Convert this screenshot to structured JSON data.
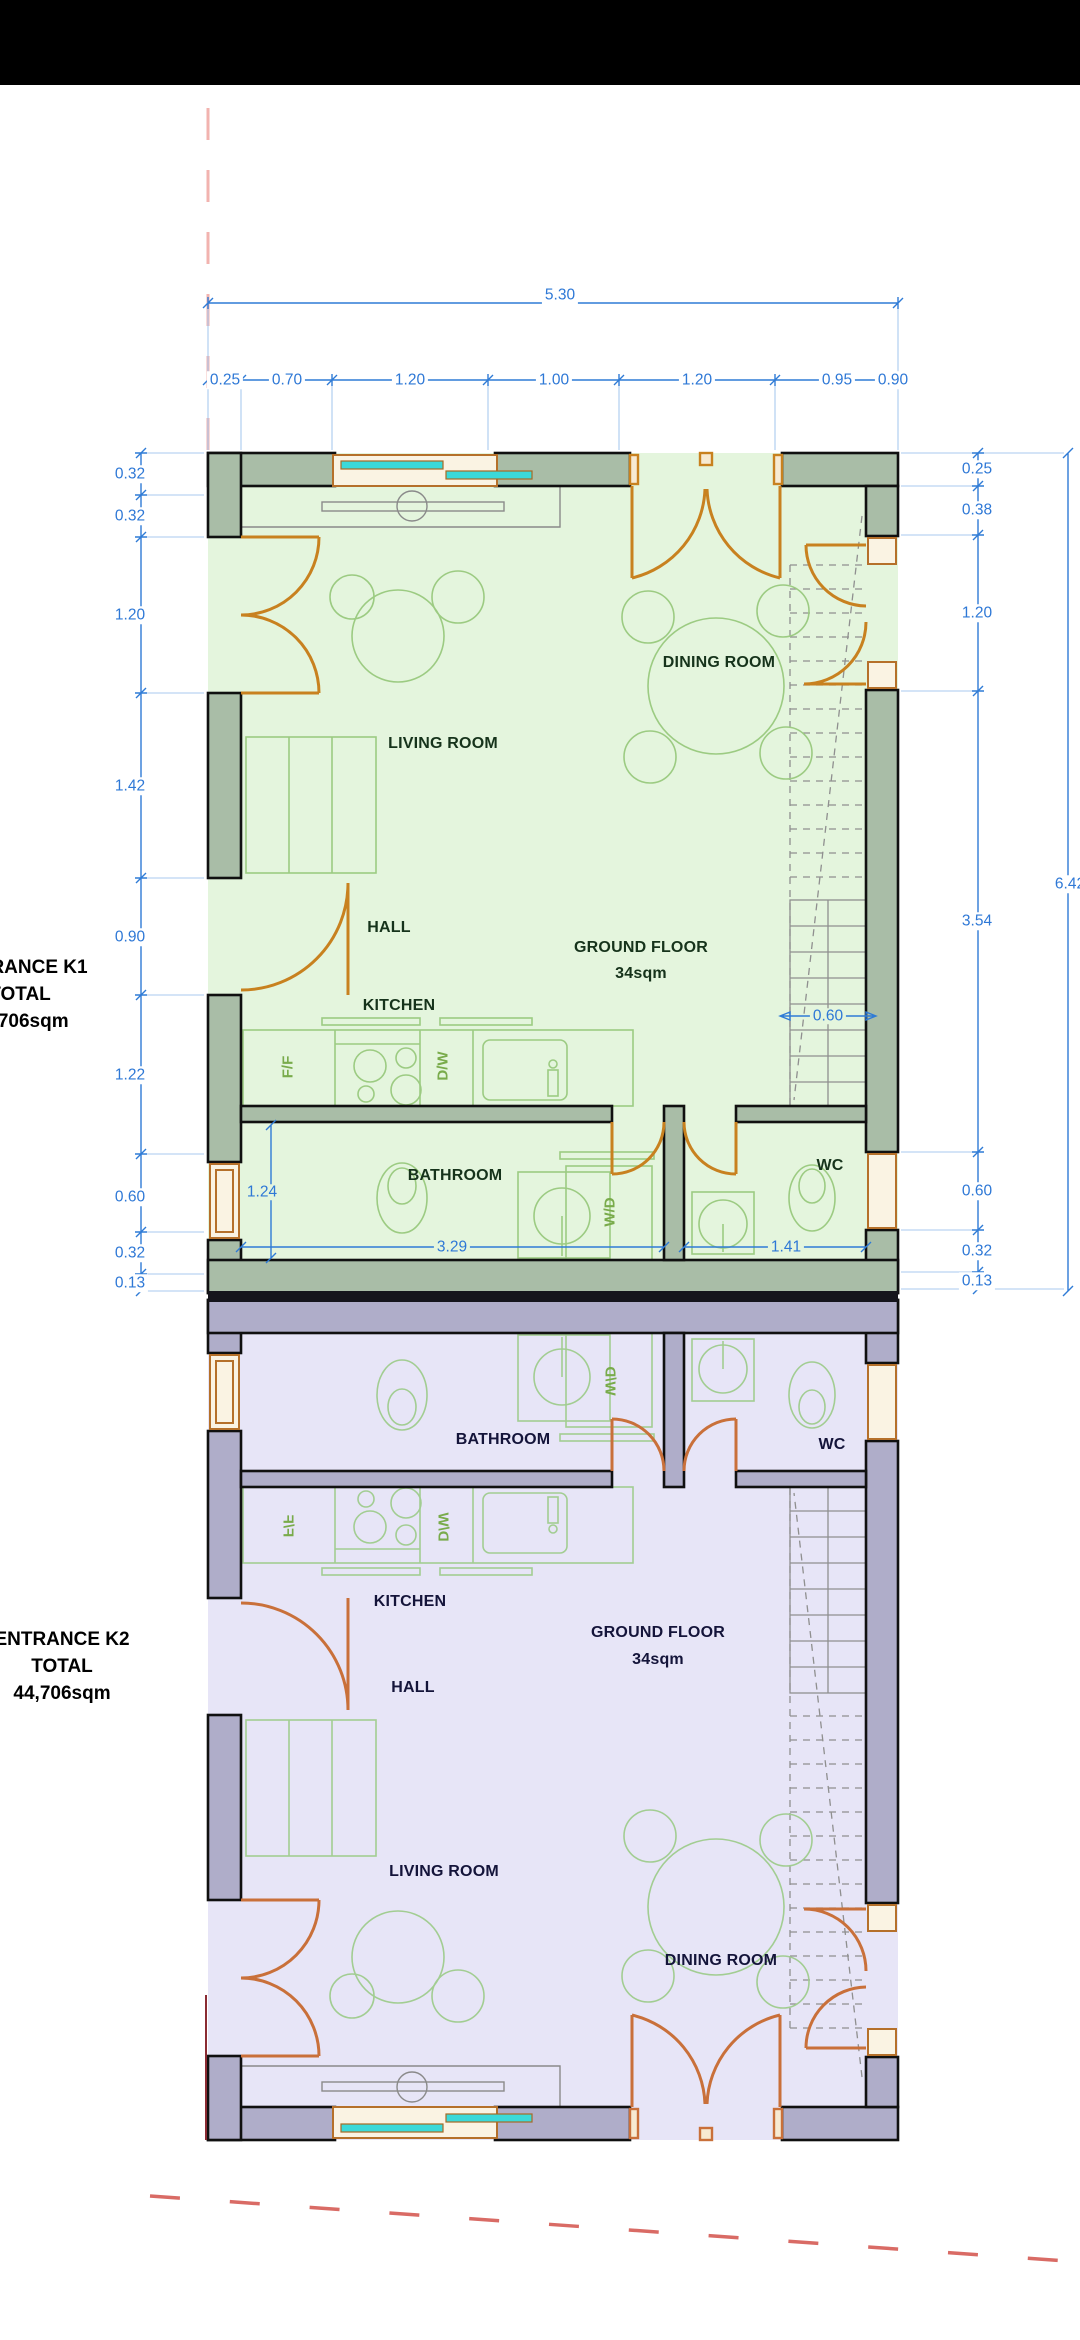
{
  "drawing_title": "Two-unit ground floor plan",
  "colors": {
    "dim_blue": "#2e78d6",
    "door_orange": "#c8811f",
    "door_orange_k2": "#c9703a",
    "unit_k1_floor": "#e4f5dd",
    "unit_k1_wall": "#a9bda7",
    "unit_k2_floor": "#e7e5f7",
    "unit_k2_wall": "#afadc9",
    "glass_cyan": "#3bd9d9",
    "construction_red": "#d96b65",
    "topbar": "#000000"
  },
  "left_annotations": {
    "k1": {
      "line1": "ENTRANCE K1",
      "line2": "TOTAL",
      "line3": "44,706sqm"
    },
    "k2": {
      "line1": "ENTRANCE K2",
      "line2": "TOTAL",
      "line3": "44,706sqm"
    }
  },
  "room_labels": [
    {
      "text": "LIVING ROOM",
      "x": 443,
      "y": 744,
      "unit": "K1"
    },
    {
      "text": "DINING ROOM",
      "x": 719,
      "y": 663,
      "unit": "K1"
    },
    {
      "text": "HALL",
      "x": 389,
      "y": 928,
      "unit": "K1"
    },
    {
      "text": "GROUND FLOOR",
      "x": 641,
      "y": 948,
      "unit": "K1"
    },
    {
      "text": "34sqm",
      "x": 641,
      "y": 974,
      "unit": "K1"
    },
    {
      "text": "KITCHEN",
      "x": 399,
      "y": 1006,
      "unit": "K1"
    },
    {
      "text": "BATHROOM",
      "x": 455,
      "y": 1176,
      "unit": "K1"
    },
    {
      "text": "WC",
      "x": 830,
      "y": 1166,
      "unit": "K1"
    },
    {
      "text": "BATHROOM",
      "x": 503,
      "y": 1440,
      "unit": "K2"
    },
    {
      "text": "WC",
      "x": 832,
      "y": 1445,
      "unit": "K2"
    },
    {
      "text": "KITCHEN",
      "x": 410,
      "y": 1602,
      "unit": "K2"
    },
    {
      "text": "GROUND FLOOR",
      "x": 658,
      "y": 1633,
      "unit": "K2"
    },
    {
      "text": "34sqm",
      "x": 658,
      "y": 1660,
      "unit": "K2"
    },
    {
      "text": "HALL",
      "x": 413,
      "y": 1688,
      "unit": "K2"
    },
    {
      "text": "LIVING ROOM",
      "x": 444,
      "y": 1872,
      "unit": "K2"
    },
    {
      "text": "DINING ROOM",
      "x": 721,
      "y": 1961,
      "unit": "K2"
    }
  ],
  "appliance_labels": [
    {
      "text": "F/F",
      "x": 288,
      "y": 1067,
      "unit": "K1"
    },
    {
      "text": "D/W",
      "x": 443,
      "y": 1066,
      "unit": "K1"
    },
    {
      "text": "W/D",
      "x": 610,
      "y": 1212,
      "unit": "K1"
    },
    {
      "text": "W/D",
      "x": 610,
      "y": 1381,
      "unit": "K2"
    },
    {
      "text": "D/W",
      "x": 443,
      "y": 1527,
      "unit": "K2"
    },
    {
      "text": "F/F",
      "x": 288,
      "y": 1526,
      "unit": "K2"
    }
  ],
  "dimensions": {
    "overall_width": {
      "text": "5.30",
      "x": 560,
      "y": 295
    },
    "overall_height": {
      "text": "6.42",
      "x": 1070,
      "y": 884
    },
    "top_segments": [
      {
        "text": "0.25",
        "x": 225,
        "y": 380
      },
      {
        "text": "0.70",
        "x": 287,
        "y": 380
      },
      {
        "text": "1.20",
        "x": 410,
        "y": 380
      },
      {
        "text": "1.00",
        "x": 554,
        "y": 380
      },
      {
        "text": "1.20",
        "x": 697,
        "y": 380
      },
      {
        "text": "0.95",
        "x": 837,
        "y": 380
      },
      {
        "text": "0.90",
        "x": 893,
        "y": 380
      }
    ],
    "left_segments": [
      {
        "text": "0.32",
        "x": 130,
        "y": 474
      },
      {
        "text": "0.32",
        "x": 130,
        "y": 516
      },
      {
        "text": "1.20",
        "x": 130,
        "y": 615
      },
      {
        "text": "1.42",
        "x": 130,
        "y": 786
      },
      {
        "text": "0.90",
        "x": 130,
        "y": 937
      },
      {
        "text": "1.22",
        "x": 130,
        "y": 1075
      },
      {
        "text": "0.60",
        "x": 130,
        "y": 1197
      },
      {
        "text": "0.32",
        "x": 130,
        "y": 1253
      },
      {
        "text": "0.13",
        "x": 130,
        "y": 1283
      }
    ],
    "right_segments": [
      {
        "text": "0.25",
        "x": 977,
        "y": 469
      },
      {
        "text": "0.38",
        "x": 977,
        "y": 510
      },
      {
        "text": "1.20",
        "x": 977,
        "y": 613
      },
      {
        "text": "3.54",
        "x": 977,
        "y": 921
      },
      {
        "text": "0.60",
        "x": 977,
        "y": 1191
      },
      {
        "text": "0.32",
        "x": 977,
        "y": 1251
      },
      {
        "text": "0.13",
        "x": 977,
        "y": 1281
      }
    ],
    "interior": [
      {
        "text": "0.60",
        "x": 828,
        "y": 1016
      },
      {
        "text": "1.24",
        "x": 262,
        "y": 1192
      },
      {
        "text": "3.29",
        "x": 452,
        "y": 1247
      },
      {
        "text": "1.41",
        "x": 786,
        "y": 1247
      }
    ]
  }
}
